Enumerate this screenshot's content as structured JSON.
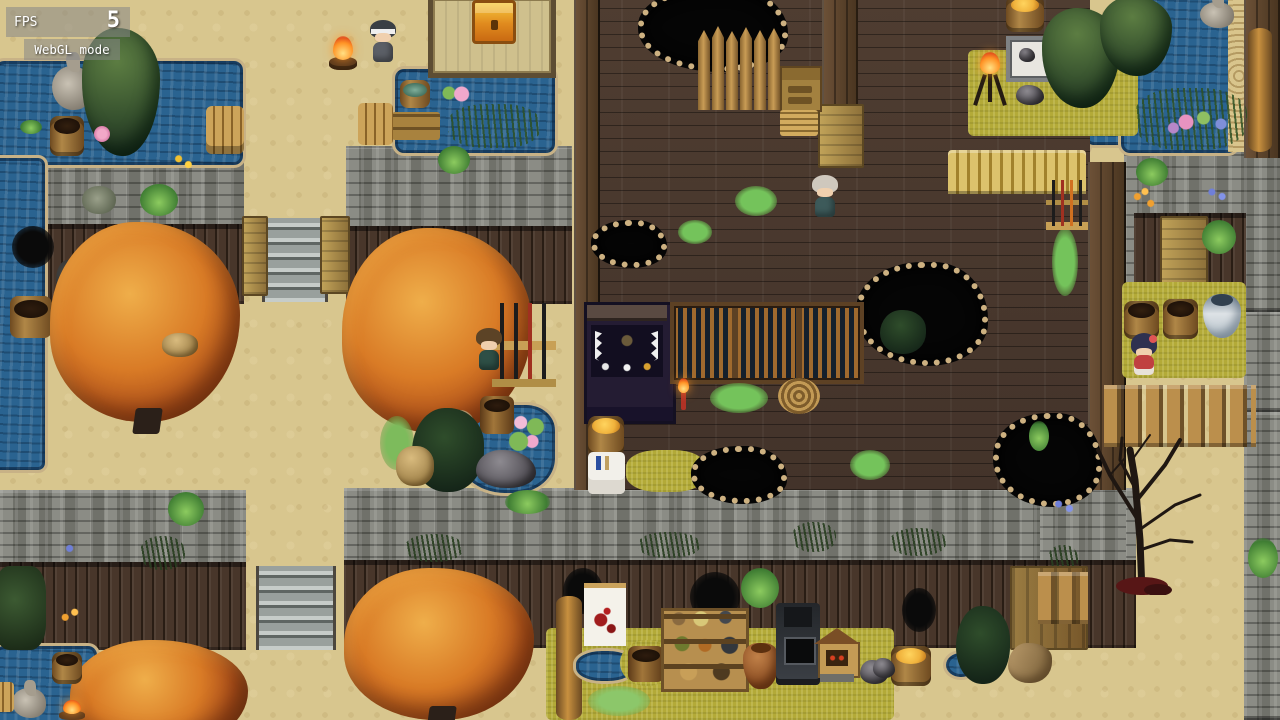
{
  "hud": {
    "fps_label": "FPS",
    "fps_value": "5",
    "mode_label": "WebGL mode"
  },
  "palette": {
    "sand": "#d8c68e",
    "water": "#2a6390",
    "pond_edge": "#c8b286",
    "stone": "#82837c",
    "fence": "#3f2f23",
    "floor": "#4a382d",
    "wall_wood": "#5a4330",
    "gate_wood": "#b89a55",
    "tatami": "#cfc08d",
    "grass_olive": "#b3aa38",
    "moss": "#74c35b",
    "autumn": "#d97b26",
    "evergreen": "#36512e",
    "pit": "#050505",
    "pit_rim": "#cdb181",
    "barrel": "#b08747",
    "amber": "#f0b23c",
    "flame": "#ff9426",
    "chest_gold": "#e8a01e",
    "banner_white": "#f4f2ea",
    "blood_red": "#a11d1d",
    "pot_blue": "#d8dde2",
    "girl_red": "#c04040",
    "hud_text": "#ffffff"
  },
  "scene": {
    "characters": [
      {
        "name": "ninja-by-campfire"
      },
      {
        "name": "villager-by-tree"
      },
      {
        "name": "old-man-indoors"
      },
      {
        "name": "girl-in-red"
      }
    ],
    "notable_objects": [
      "treasure-chest",
      "campfire",
      "shrine-altar",
      "weapon-rack",
      "rope-coil",
      "candle",
      "forge",
      "market-shelf",
      "mini-shrine",
      "blood-banner",
      "dead-tree",
      "heron-statue"
    ]
  }
}
